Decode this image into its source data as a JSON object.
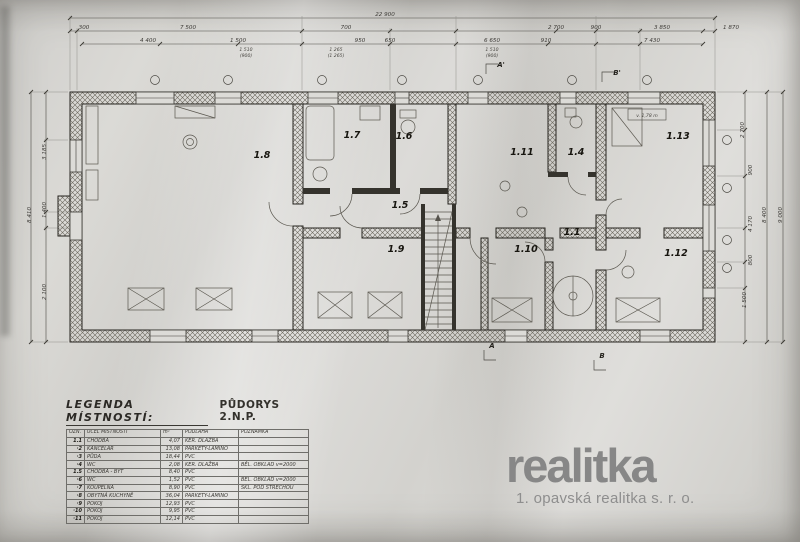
{
  "scan": {
    "logo": {
      "name": "realitka",
      "tagline": "1. opavská realitka s. r. o."
    },
    "legend": {
      "title": "LEGENDA MÍSTNOSTÍ:",
      "plan_title": "PŮDORYS 2.N.P.",
      "columns": [
        "OZN.",
        "ÚČEL MÍSTNOSTI",
        "m²",
        "PODLAHA",
        "POZNÁMKA"
      ],
      "rows": [
        {
          "ozn": "1.1",
          "ucel": "CHODBA",
          "m2": "4,07",
          "podlaha": "KER. DLAŽBA",
          "pozn": ""
        },
        {
          "ozn": "·2",
          "ucel": "KANCELÁŘ",
          "m2": "13,08",
          "podlaha": "PARKETY-LAMINO",
          "pozn": ""
        },
        {
          "ozn": "·3",
          "ucel": "PŮDA",
          "m2": "18,44",
          "podlaha": "PVC",
          "pozn": ""
        },
        {
          "ozn": "·4",
          "ucel": "WC",
          "m2": "2,08",
          "podlaha": "KER. DLAŽBA",
          "pozn": "BĚL. OBKLAD v=2000"
        },
        {
          "ozn": "1.5",
          "ucel": "CHODBA - BYT",
          "m2": "8,40",
          "podlaha": "PVC",
          "pozn": ""
        },
        {
          "ozn": "·6",
          "ucel": "WC",
          "m2": "1,52",
          "podlaha": "PVC",
          "pozn": "BĚL. OBKLAD v=2000"
        },
        {
          "ozn": "·7",
          "ucel": "KOUPELNA",
          "m2": "8,90",
          "podlaha": "PVC",
          "pozn": "SKL. POD STŘECHOU"
        },
        {
          "ozn": "·8",
          "ucel": "OBYTNÁ KUCHYNĚ",
          "m2": "36,04",
          "podlaha": "PARKETY-LAMINO",
          "pozn": ""
        },
        {
          "ozn": "·9",
          "ucel": "POKOJ",
          "m2": "12,93",
          "podlaha": "PVC",
          "pozn": ""
        },
        {
          "ozn": "·10",
          "ucel": "POKOJ",
          "m2": "9,95",
          "podlaha": "PVC",
          "pozn": ""
        },
        {
          "ozn": "·11",
          "ucel": "POKOJ",
          "m2": "12,14",
          "podlaha": "PVC",
          "pozn": ""
        }
      ]
    },
    "plan": {
      "rooms": [
        "1.8",
        "1.7",
        "1.6",
        "1.5",
        "1.9",
        "1.11",
        "1.4",
        "1.13",
        "1.1",
        "1.10",
        "1.12"
      ],
      "note": "v. 1,78 m",
      "sections": {
        "a_top": "A'",
        "b_top": "B'",
        "a_bot": "A",
        "b_bot": "B"
      },
      "dims_top": [
        "22 900",
        "300",
        "7 500",
        "700",
        "2 700",
        "900",
        "3 850",
        "1 870",
        "4 400",
        "1 500",
        "950",
        "650",
        "6 650",
        "910",
        "7 430"
      ],
      "dims_sub": [
        "1 510",
        "(900)",
        "1 265",
        "(1 265)",
        "1 510",
        "(900)"
      ],
      "dims_left": [
        "8 410",
        "3 185",
        "1 400",
        "2 100"
      ],
      "dims_right": [
        "2 700",
        "900",
        "4 170",
        "800",
        "1 500",
        "8 400",
        "9 000"
      ]
    }
  }
}
